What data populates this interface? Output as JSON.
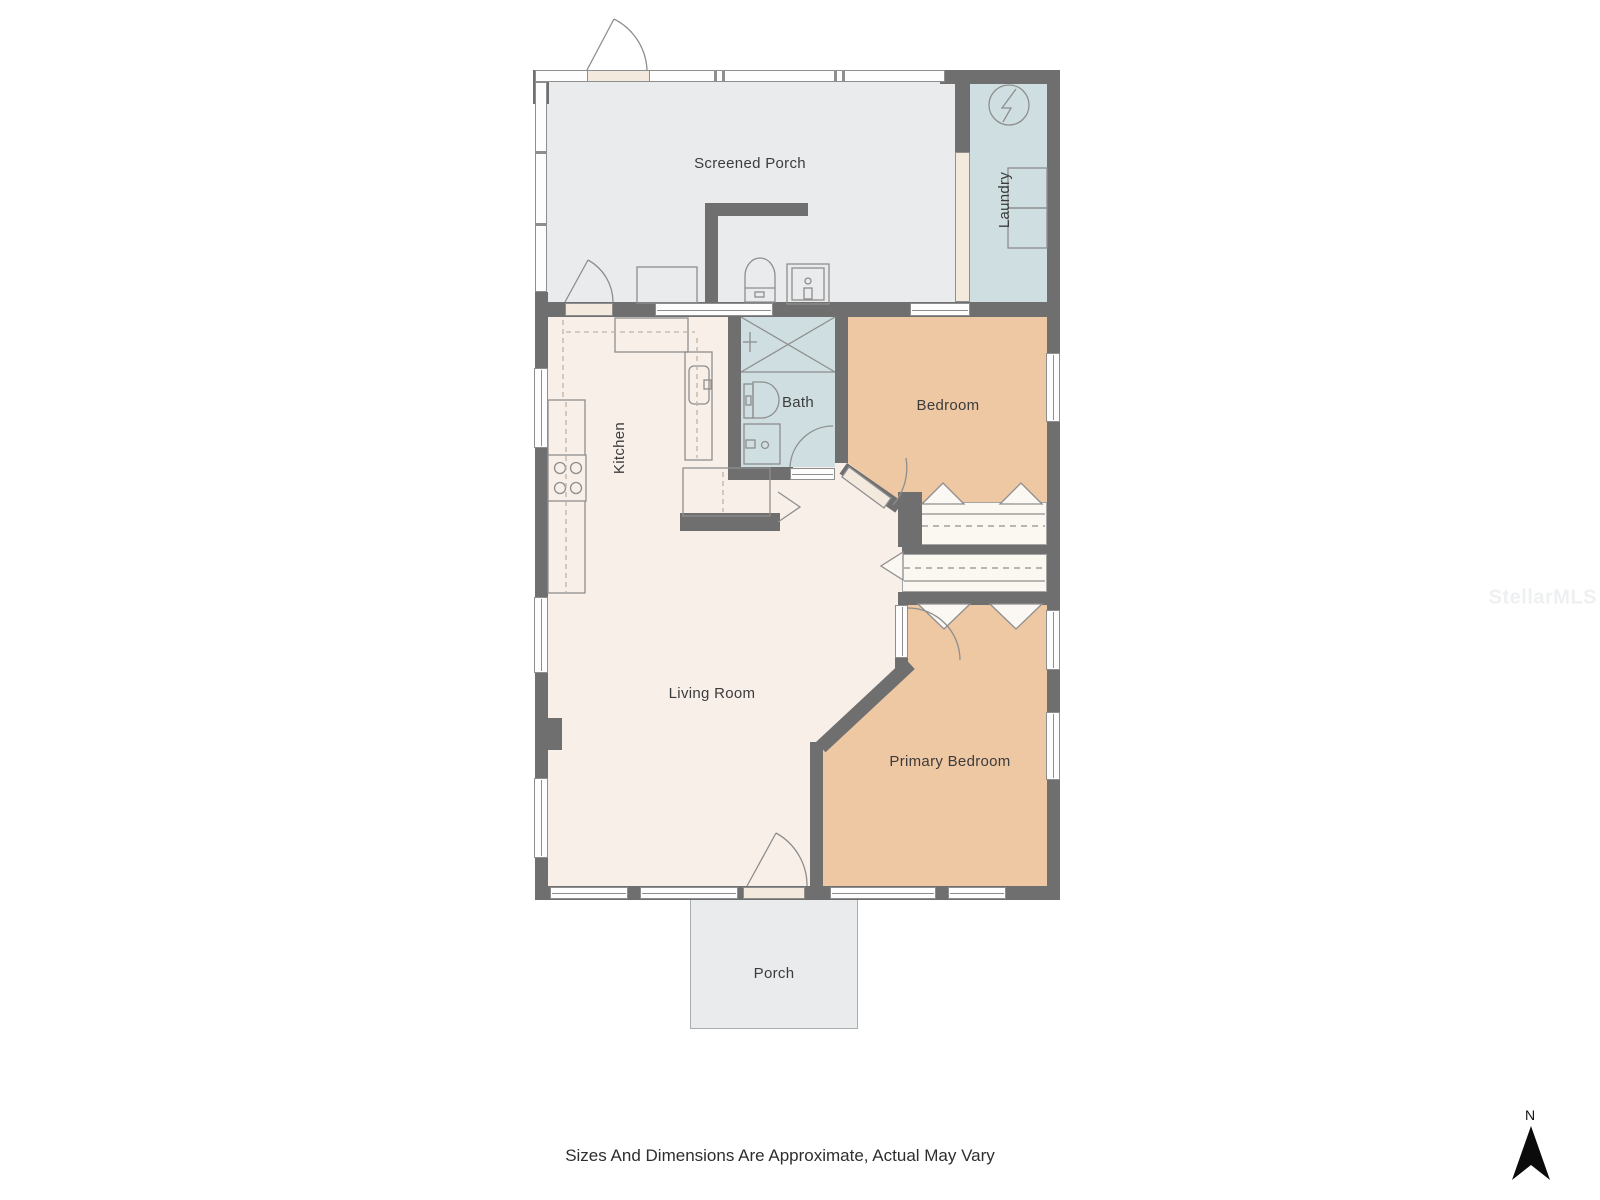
{
  "rooms": {
    "screened_porch": {
      "label": "Screened Porch"
    },
    "laundry": {
      "label": "Laundry"
    },
    "kitchen": {
      "label": "Kitchen"
    },
    "bath": {
      "label": "Bath"
    },
    "bedroom": {
      "label": "Bedroom"
    },
    "living_room": {
      "label": "Living Room"
    },
    "primary_bedroom": {
      "label": "Primary Bedroom"
    },
    "porch": {
      "label": "Porch"
    }
  },
  "annotations": {
    "disclaimer": "Sizes And Dimensions Are Approximate, Actual May Vary",
    "compass_label": "N",
    "watermark": "StellarMLS"
  },
  "colors": {
    "wall": "#6f6f6f",
    "floor_cream": "#f8efe9",
    "floor_tan": "#eec7a3",
    "floor_wet": "#cfdfe1",
    "floor_porch": "#e9ebec",
    "door": "#f3e9dc",
    "line": "#8e8e8e",
    "dashed": "#bdb4a8",
    "closet": "#fbf7f1",
    "text": "#3c3c3c",
    "compass": "#0b0b0b",
    "watermark_color": "#eef0f1"
  }
}
